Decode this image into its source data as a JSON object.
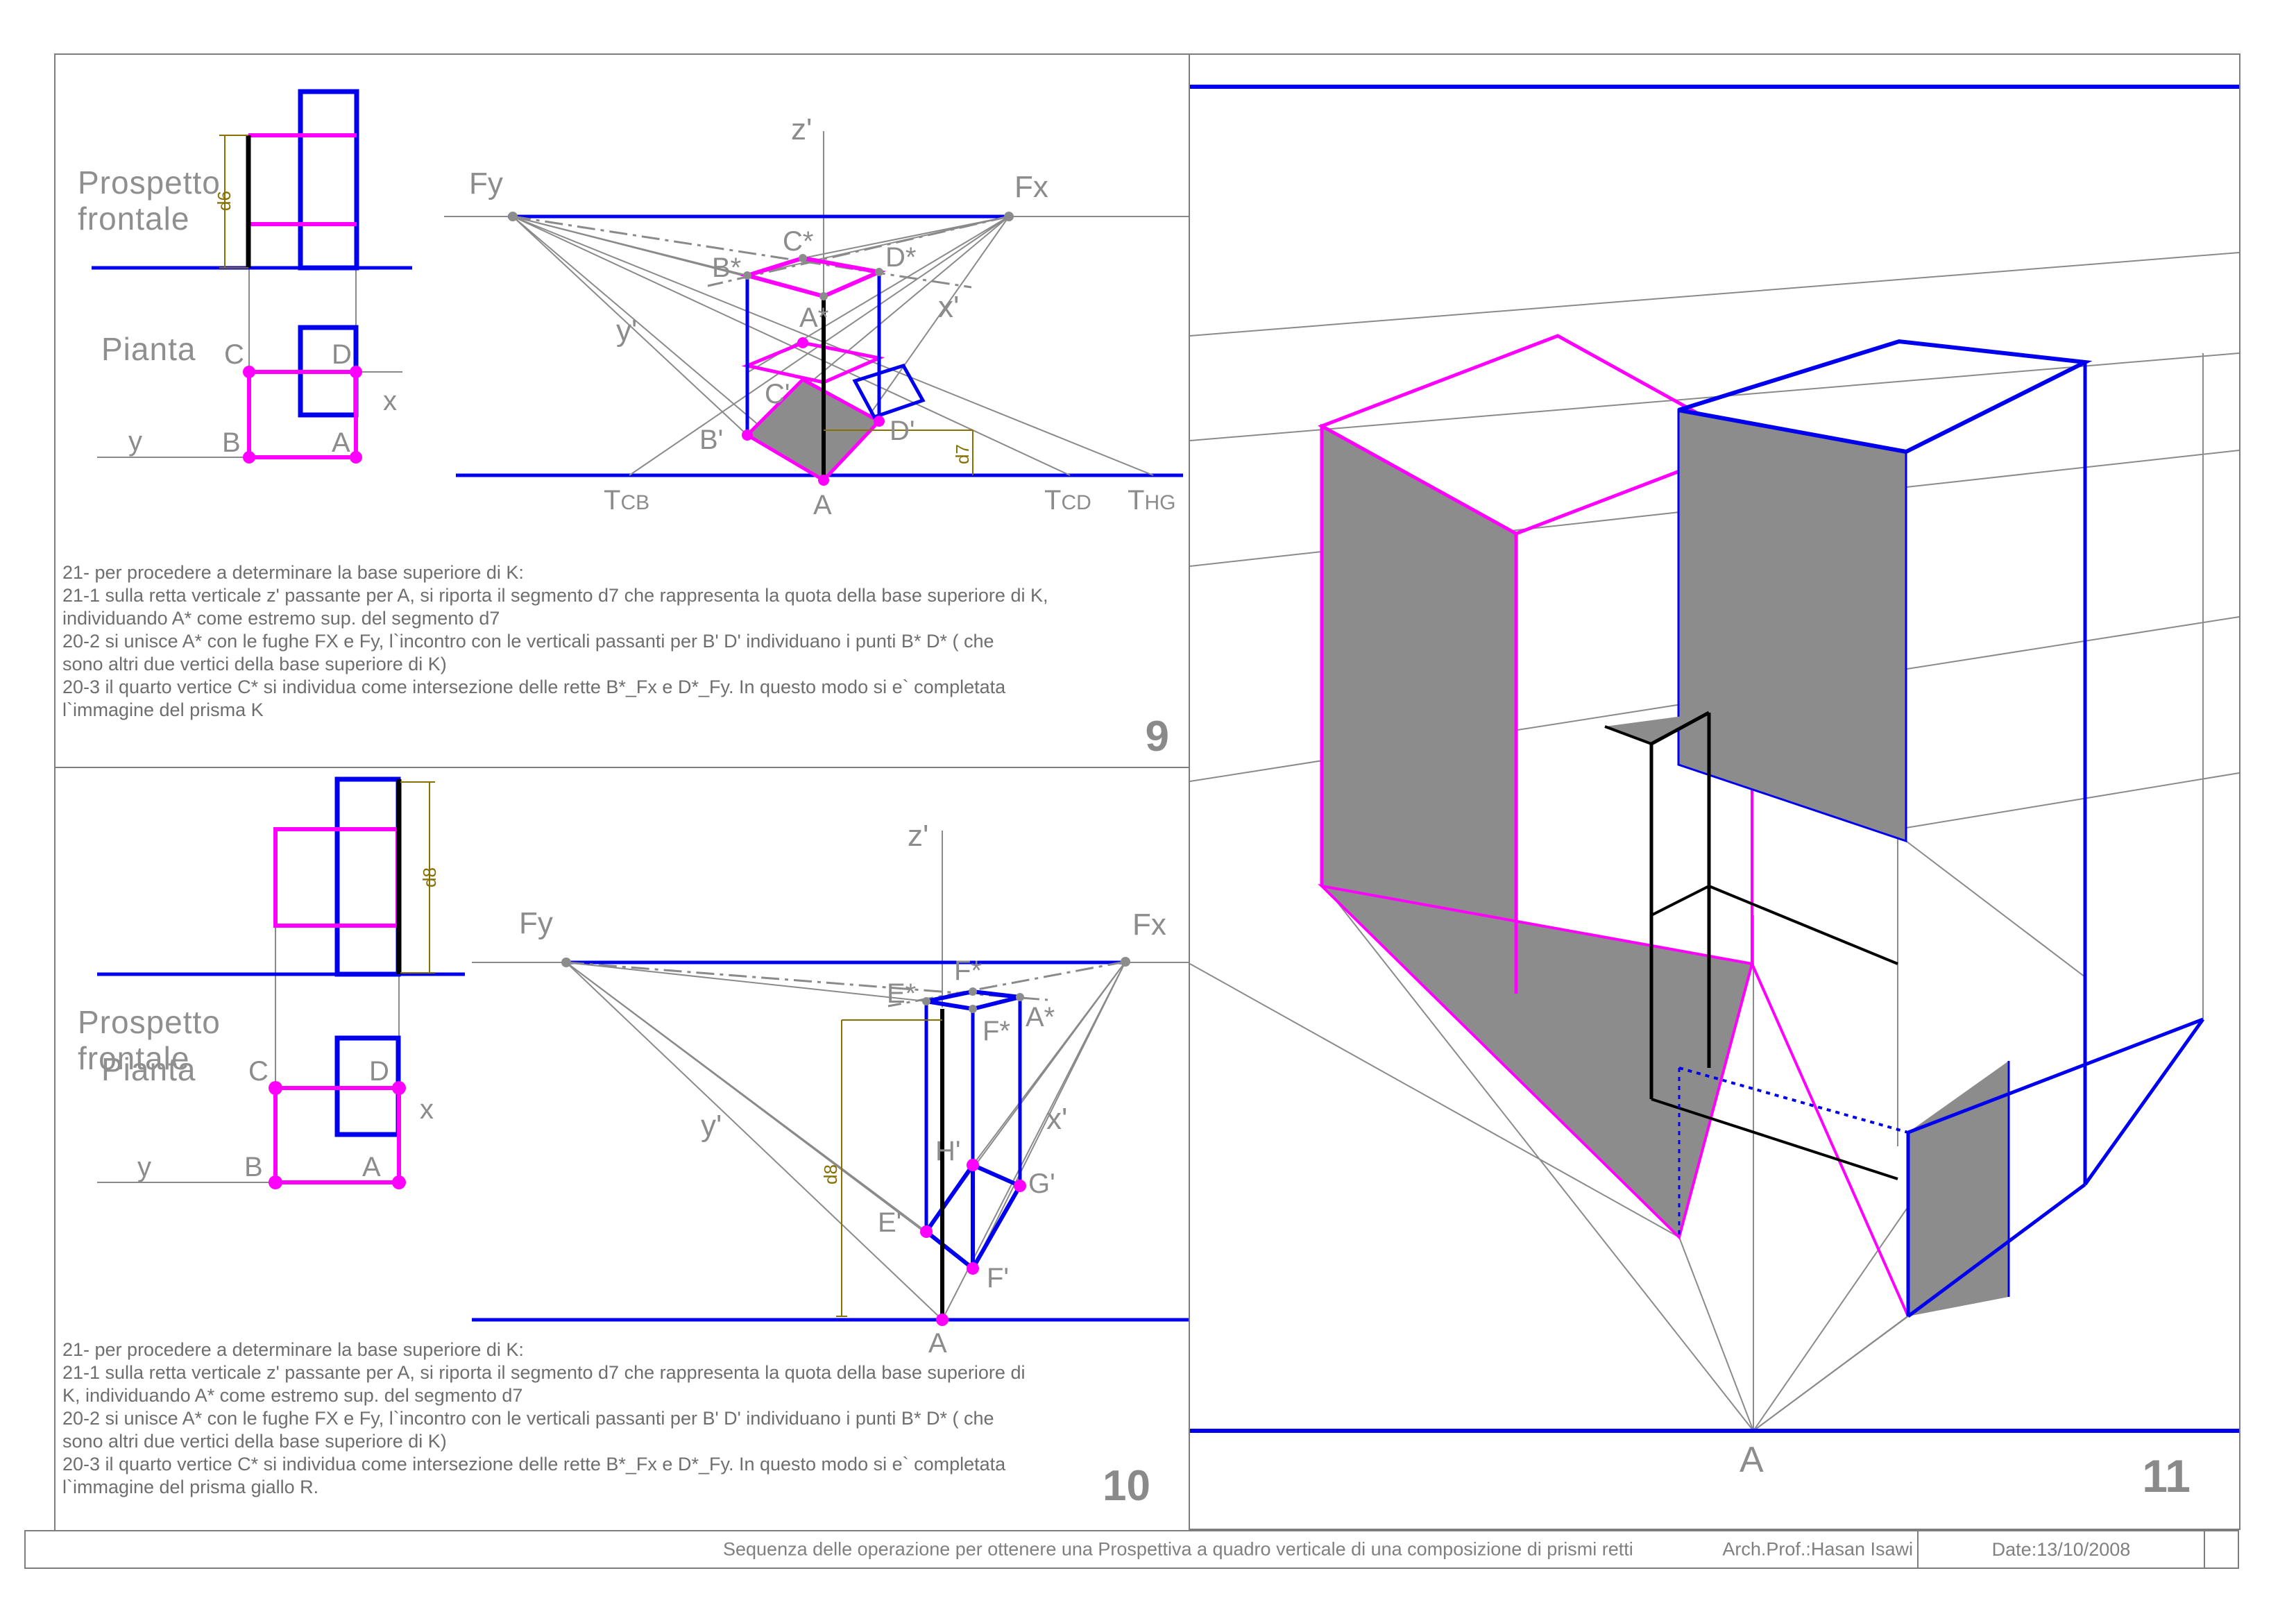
{
  "panel9": {
    "number": "9",
    "ortho": {
      "title_line1": "Prospetto",
      "title_line2": "frontale",
      "pianta_label": "Pianta",
      "dim_label": "d6",
      "pt_C": "C",
      "pt_D": "D",
      "pt_B": "B",
      "pt_A": "A",
      "axis_x": "x",
      "axis_y": "y"
    },
    "persp": {
      "z_axis": "z'",
      "Fy": "Fy",
      "Fx": "Fx",
      "y_axis": "y'",
      "x_axis": "x'",
      "B_star": "B*",
      "C_star": "C*",
      "D_star": "D*",
      "A_star": "A*",
      "C_prime": "C'",
      "B_prime": "B'",
      "D_prime": "D'",
      "A_ground": "A",
      "T_cb_T": "T",
      "T_cb_sub": "CB",
      "T_cd_T": "T",
      "T_cd_sub": "CD",
      "T_hg_T": "T",
      "T_hg_sub": "HG",
      "dim_label": "d7"
    },
    "caption": [
      "21- per procedere a determinare la base superiore di K:",
      "21-1 sulla retta verticale z' passante per A, si riporta il segmento d7 che rappresenta la quota della base superiore di K,",
      "individuando A* come estremo sup. del segmento d7",
      "20-2 si unisce A* con le fughe FX e Fy, l`incontro con le verticali passanti per B' D' individuano i punti B* D* ( che",
      "sono altri due vertici della base superiore di K)",
      "20-3 il quarto vertice C* si individua come intersezione delle rette B*_Fx e D*_Fy. In questo modo si e` completata",
      "l`immagine del prisma K"
    ]
  },
  "panel10": {
    "number": "10",
    "ortho": {
      "title_line1": "Prospetto",
      "title_line2": "frontale",
      "pianta_label": "Pianta",
      "dim_label": "d8",
      "pt_C": "C",
      "pt_D": "D",
      "pt_B": "B",
      "pt_A": "A",
      "axis_x": "x",
      "axis_y": "y"
    },
    "persp": {
      "z_axis": "z'",
      "Fy": "Fy",
      "Fx": "Fx",
      "y_axis": "y'",
      "x_axis": "x'",
      "E_star": "E*",
      "F_star_top": "F*",
      "F_star_low": "F*",
      "A_star": "A*",
      "H_prime": "H'",
      "G_prime": "G'",
      "E_prime": "E'",
      "F_prime": "F'",
      "A_ground": "A",
      "dim_label": "d8"
    },
    "caption": [
      "21- per procedere a determinare la base superiore di K:",
      "21-1 sulla retta verticale z' passante per A, si riporta il segmento d7 che rappresenta la quota della base superiore di",
      "K, individuando A* come estremo sup. del segmento d7",
      "20-2 si unisce A* con le fughe FX e Fy, l`incontro con le verticali passanti per B' D' individuano i punti B* D* ( che",
      "sono altri due vertici della base superiore di K)",
      "20-3 il quarto vertice C* si individua come intersezione delle rette B*_Fx e D*_Fy. In questo modo si e` completata",
      "l`immagine del prisma giallo R."
    ]
  },
  "panel11": {
    "number": "11",
    "A_label": "A"
  },
  "footer": {
    "title": "Sequenza delle operazione per ottenere una Prospettiva a quadro verticale di una composizione di prismi retti",
    "author": "Arch.Prof.:Hasan Isawi",
    "date": "Date:13/10/2008"
  },
  "colors": {
    "blue": "#0000ee",
    "magenta": "#ff00ff",
    "olive": "#857000",
    "gray_fill": "#8c8c8c",
    "gray_line": "#8a8a8a"
  }
}
